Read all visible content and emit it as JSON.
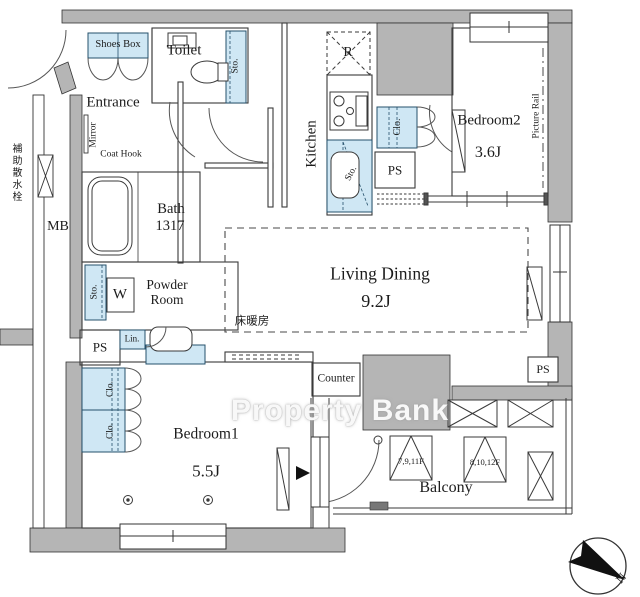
{
  "watermark": "Property Bank",
  "compass": {
    "north": "N"
  },
  "colors": {
    "wall_gray": "#b5b5b5",
    "fixture_blue": "#cfe7f4",
    "line": "#3a3a3a"
  },
  "rooms": {
    "entrance": {
      "name": "Entrance",
      "shoes_box": "Shoes Box",
      "mirror": "Mirror",
      "coat_hook": "Coat Hook"
    },
    "toilet": {
      "name": "Toilet",
      "storage": "Sto."
    },
    "kitchen": {
      "name": "Kitchen",
      "refrigerator": "R",
      "storage": "Sto.",
      "closet": "Clo.",
      "pipe_space": "PS"
    },
    "bath": {
      "name": "Bath",
      "size": "1317"
    },
    "powder_room": {
      "name": "Powder Room",
      "storage": "Sto.",
      "washer": "W",
      "linen": "Lin.",
      "pipe_space": "PS"
    },
    "living_dining": {
      "name": "Living Dining",
      "size": "9.2J",
      "floor_heating": "床暖房",
      "counter": "Counter",
      "pipe_space": "PS"
    },
    "bedroom1": {
      "name": "Bedroom1",
      "size": "5.5J",
      "closet_upper": "Clo.",
      "closet_lower": "Clo."
    },
    "bedroom2": {
      "name": "Bedroom2",
      "size": "3.6J",
      "picture_rail": "Picture Rail"
    },
    "balcony": {
      "name": "Balcony",
      "ac_unit_floors_a": "7,9,11F",
      "ac_unit_floors_b": "8,10,12F"
    },
    "exterior": {
      "meter_box": "MB",
      "aux_sprinkler": "補助散水栓"
    }
  }
}
